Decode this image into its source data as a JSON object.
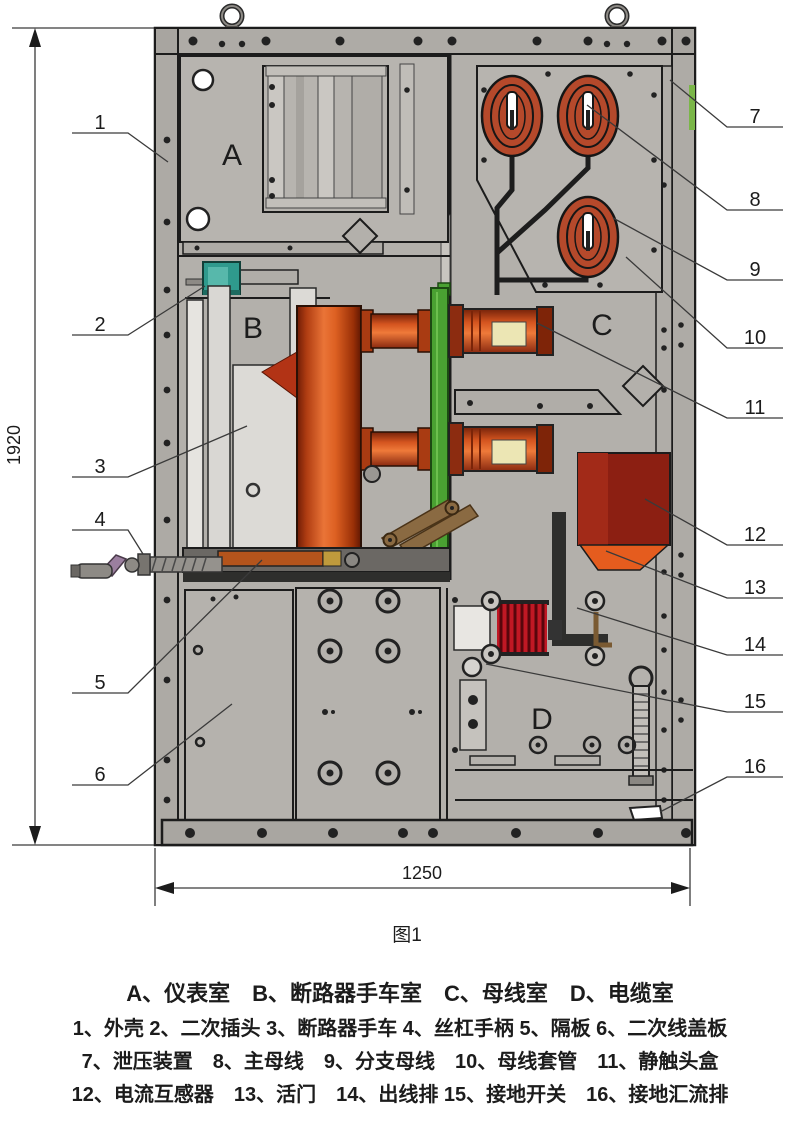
{
  "figure": {
    "caption": "图1",
    "dimensions": {
      "height": "1920",
      "width": "1250"
    }
  },
  "compartments": {
    "a": "A",
    "b": "B",
    "c": "C",
    "d": "D"
  },
  "callouts": {
    "left": [
      "1",
      "2",
      "3",
      "4",
      "5",
      "6"
    ],
    "right": [
      "7",
      "8",
      "9",
      "10",
      "11",
      "12",
      "13",
      "14",
      "15",
      "16"
    ]
  },
  "legend": {
    "compartments": "A、仪表室　B、断路器手车室　C、母线室　D、电缆室",
    "parts_line1": "1、外壳 2、二次插头 3、断路器手车 4、丝杠手柄 5、隔板 6、二次线盖板",
    "parts_line2": "7、泄压装置　8、主母线　9、分支母线　10、母线套管　11、静触头盒",
    "parts_line3": "12、电流互感器　13、活门　14、出线排 15、接地开关　16、接地汇流排"
  },
  "colors": {
    "cabinet_gray": "#b3b0ab",
    "outline": "#1c1c1c",
    "busbar_red": "#b5492b",
    "pole_orange": "#d85a20",
    "shutter_green": "#4aa132",
    "plug_teal": "#2f9a8d",
    "ct_dark_red": "#8c1f12",
    "ct_orange": "#e55c1e",
    "termination_red": "#c01824",
    "contact_cream": "#ece6b4",
    "linkage_brown": "#8a6a42"
  }
}
